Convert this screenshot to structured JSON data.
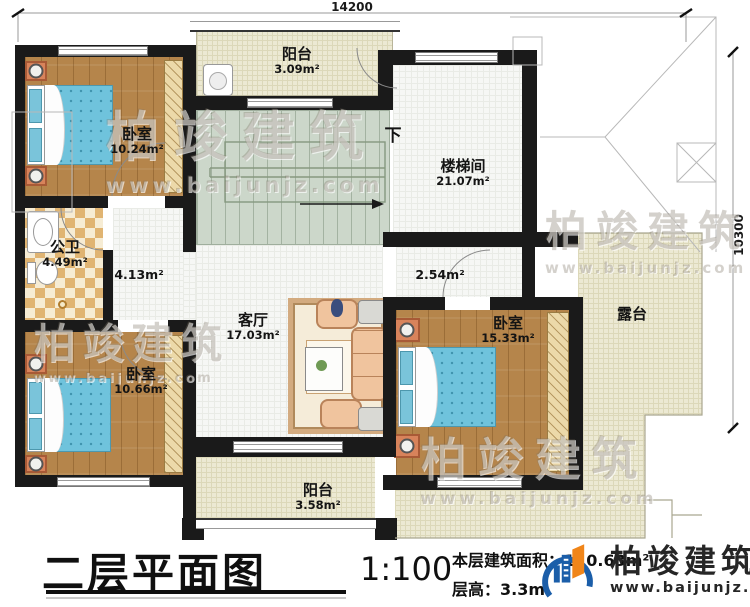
{
  "plan": {
    "title": "二层平面图",
    "scale": "1:100",
    "area_label": "本层建筑面积：",
    "area_value": "110.63m²",
    "floor_height_label": "层高：",
    "floor_height_value": "3.3m"
  },
  "dimensions": {
    "top": "14200",
    "right": "10300"
  },
  "rooms": {
    "balcony_top": {
      "name": "阳台",
      "area": "3.09m²"
    },
    "bedroom_top_left": {
      "name": "卧室",
      "area": "10.24m²"
    },
    "stairwell": {
      "name": "楼梯间",
      "area": "21.07m²"
    },
    "stairs_down": "下",
    "bathroom": {
      "name": "公卫",
      "area": "4.49m²"
    },
    "hallway": {
      "area": "4.13m²"
    },
    "hallway_right": {
      "area": "2.54m²"
    },
    "living_room": {
      "name": "客厅",
      "area": "17.03m²"
    },
    "bedroom_right": {
      "name": "卧室",
      "area": "15.33m²"
    },
    "terrace": {
      "name": "露台"
    },
    "bedroom_bottom_left": {
      "name": "卧室",
      "area": "10.66m²"
    },
    "balcony_bottom": {
      "name": "阳台",
      "area": "3.58m²"
    }
  },
  "branding": {
    "company": "柏竣建筑",
    "website": "www.baijunjz.com"
  },
  "watermark": {
    "company": "柏竣建筑",
    "website": "www.baijunjz.com"
  },
  "colors": {
    "wall": "#1a1a1a",
    "wood": "#b5854b",
    "bed": "#6fc3dc",
    "stairs": "#ccd7ca",
    "cream": "#ece9d3",
    "logo_blue": "#1b5ea9",
    "logo_orange": "#f08519"
  }
}
